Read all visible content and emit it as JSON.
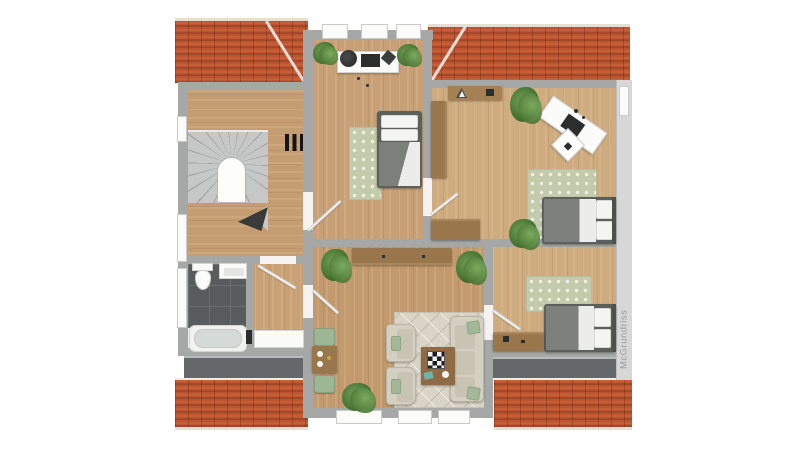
{
  "watermark": "McGrundriss",
  "palette": {
    "background": "#ffffff",
    "roof_tile": "#bf5530",
    "roof_ridge": "#e7ded3",
    "wall": "#a6a8a7",
    "wall_light": "#d6d7d6",
    "wood_floor": "#c9a176",
    "bath_tile": "#585c5f",
    "flat_roof": "#65686a",
    "stair_tread": "#c6c8c7",
    "rug_sage": "#c4caac",
    "rug_beige": "#d9d4c5",
    "bed_duvet": "#7d7f7a",
    "pillow_white": "#f4f4f2",
    "sofa_beige": "#d4d0c1",
    "cushion_green": "#a3b799",
    "furniture_brown": "#9a764c",
    "plant_green": "#4a7634",
    "door_leaf": "#ffffff",
    "stairs_arrow": "#383b3a"
  },
  "floorplan": {
    "view": "top-down upper-floor plan",
    "rooms": [
      {
        "id": "hall-stairs",
        "items": [
          "staircase",
          "stair-void-arch",
          "direction-arrow",
          "radiator"
        ]
      },
      {
        "id": "office-bedroom-top",
        "items": [
          "desk",
          "desk-chair",
          "monitor",
          "single-bed",
          "rug",
          "potted-plant",
          "potted-plant"
        ]
      },
      {
        "id": "bedroom-right-middle",
        "items": [
          "corner-shelf",
          "wardrobe",
          "angled-desk",
          "laptop",
          "desk-chair",
          "ceiling-lamp",
          "rug",
          "double-bed",
          "dresser",
          "potted-plant",
          "potted-plant"
        ]
      },
      {
        "id": "bedroom-right-bottom",
        "items": [
          "rug",
          "double-bed",
          "sideboard"
        ]
      },
      {
        "id": "bathroom",
        "items": [
          "toilet",
          "sink",
          "bathtub",
          "cabinet"
        ]
      },
      {
        "id": "living-room",
        "items": [
          "sideboard",
          "dining-table",
          "dining-chair",
          "dining-chair",
          "rug",
          "armchair",
          "armchair",
          "sofa",
          "coffee-table",
          "chess-board",
          "potted-plant",
          "potted-plant",
          "potted-plant"
        ]
      }
    ],
    "window_count": 10,
    "door_count": 5
  }
}
